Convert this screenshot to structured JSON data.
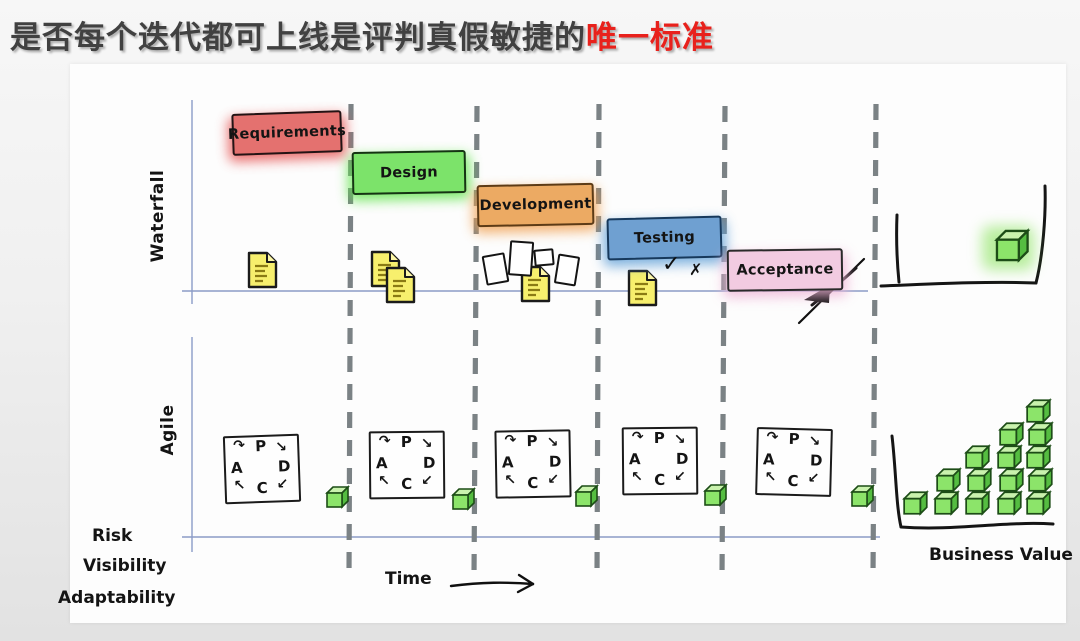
{
  "title": {
    "prefix": "是否每个迭代都可上线是评判真假敏捷的",
    "highlight": "唯一标准",
    "text_color": "#414141",
    "highlight_color": "#e8211c"
  },
  "waterfall": {
    "row_label": "Waterfall",
    "phases": [
      {
        "label": "Requirements",
        "fill": "#e4716f",
        "border": "#241314",
        "glow": "#e54f4e"
      },
      {
        "label": "Design",
        "fill": "#7ce36a",
        "border": "#153413",
        "glow": "#5fe44a"
      },
      {
        "label": "Development",
        "fill": "#ecaa63",
        "border": "#5d3b16",
        "glow": "#f09f4f"
      },
      {
        "label": "Testing",
        "fill": "#6fa0d1",
        "border": "#17395c",
        "glow": "#5e9ed6"
      },
      {
        "label": "Acceptance",
        "fill": "#f2cbe1",
        "border": "#2a2a2a",
        "glow": "#eeb4d6"
      }
    ],
    "check_mark": "✓",
    "cross_mark": "✗",
    "artifact_icon": "yellow-document"
  },
  "agile": {
    "row_label": "Agile",
    "iteration_count": 5,
    "pdca": {
      "p": "P",
      "d": "D",
      "c": "C",
      "a": "A",
      "arrow_a_to_p": "↷",
      "arrow_p_to_d": "↘",
      "arrow_d_to_c": "↙",
      "arrow_c_to_a": "↖"
    },
    "increment_icon": "green-cube"
  },
  "axes": {
    "y_labels": [
      "Risk",
      "Visibility",
      "Adaptability"
    ],
    "x_label": "Time",
    "axis_color": "#8b9cc7",
    "divider_color": "#7b8285"
  },
  "business_value": {
    "label": "Business Value",
    "stack_counts": [
      1,
      2,
      3,
      4,
      5
    ],
    "cube_colors": {
      "front": "#8ce46a",
      "top": "#c9f2ad",
      "side": "#55bd41",
      "outline": "#1d4d17"
    }
  },
  "release": {
    "icon": "green-cube-in-bin"
  }
}
